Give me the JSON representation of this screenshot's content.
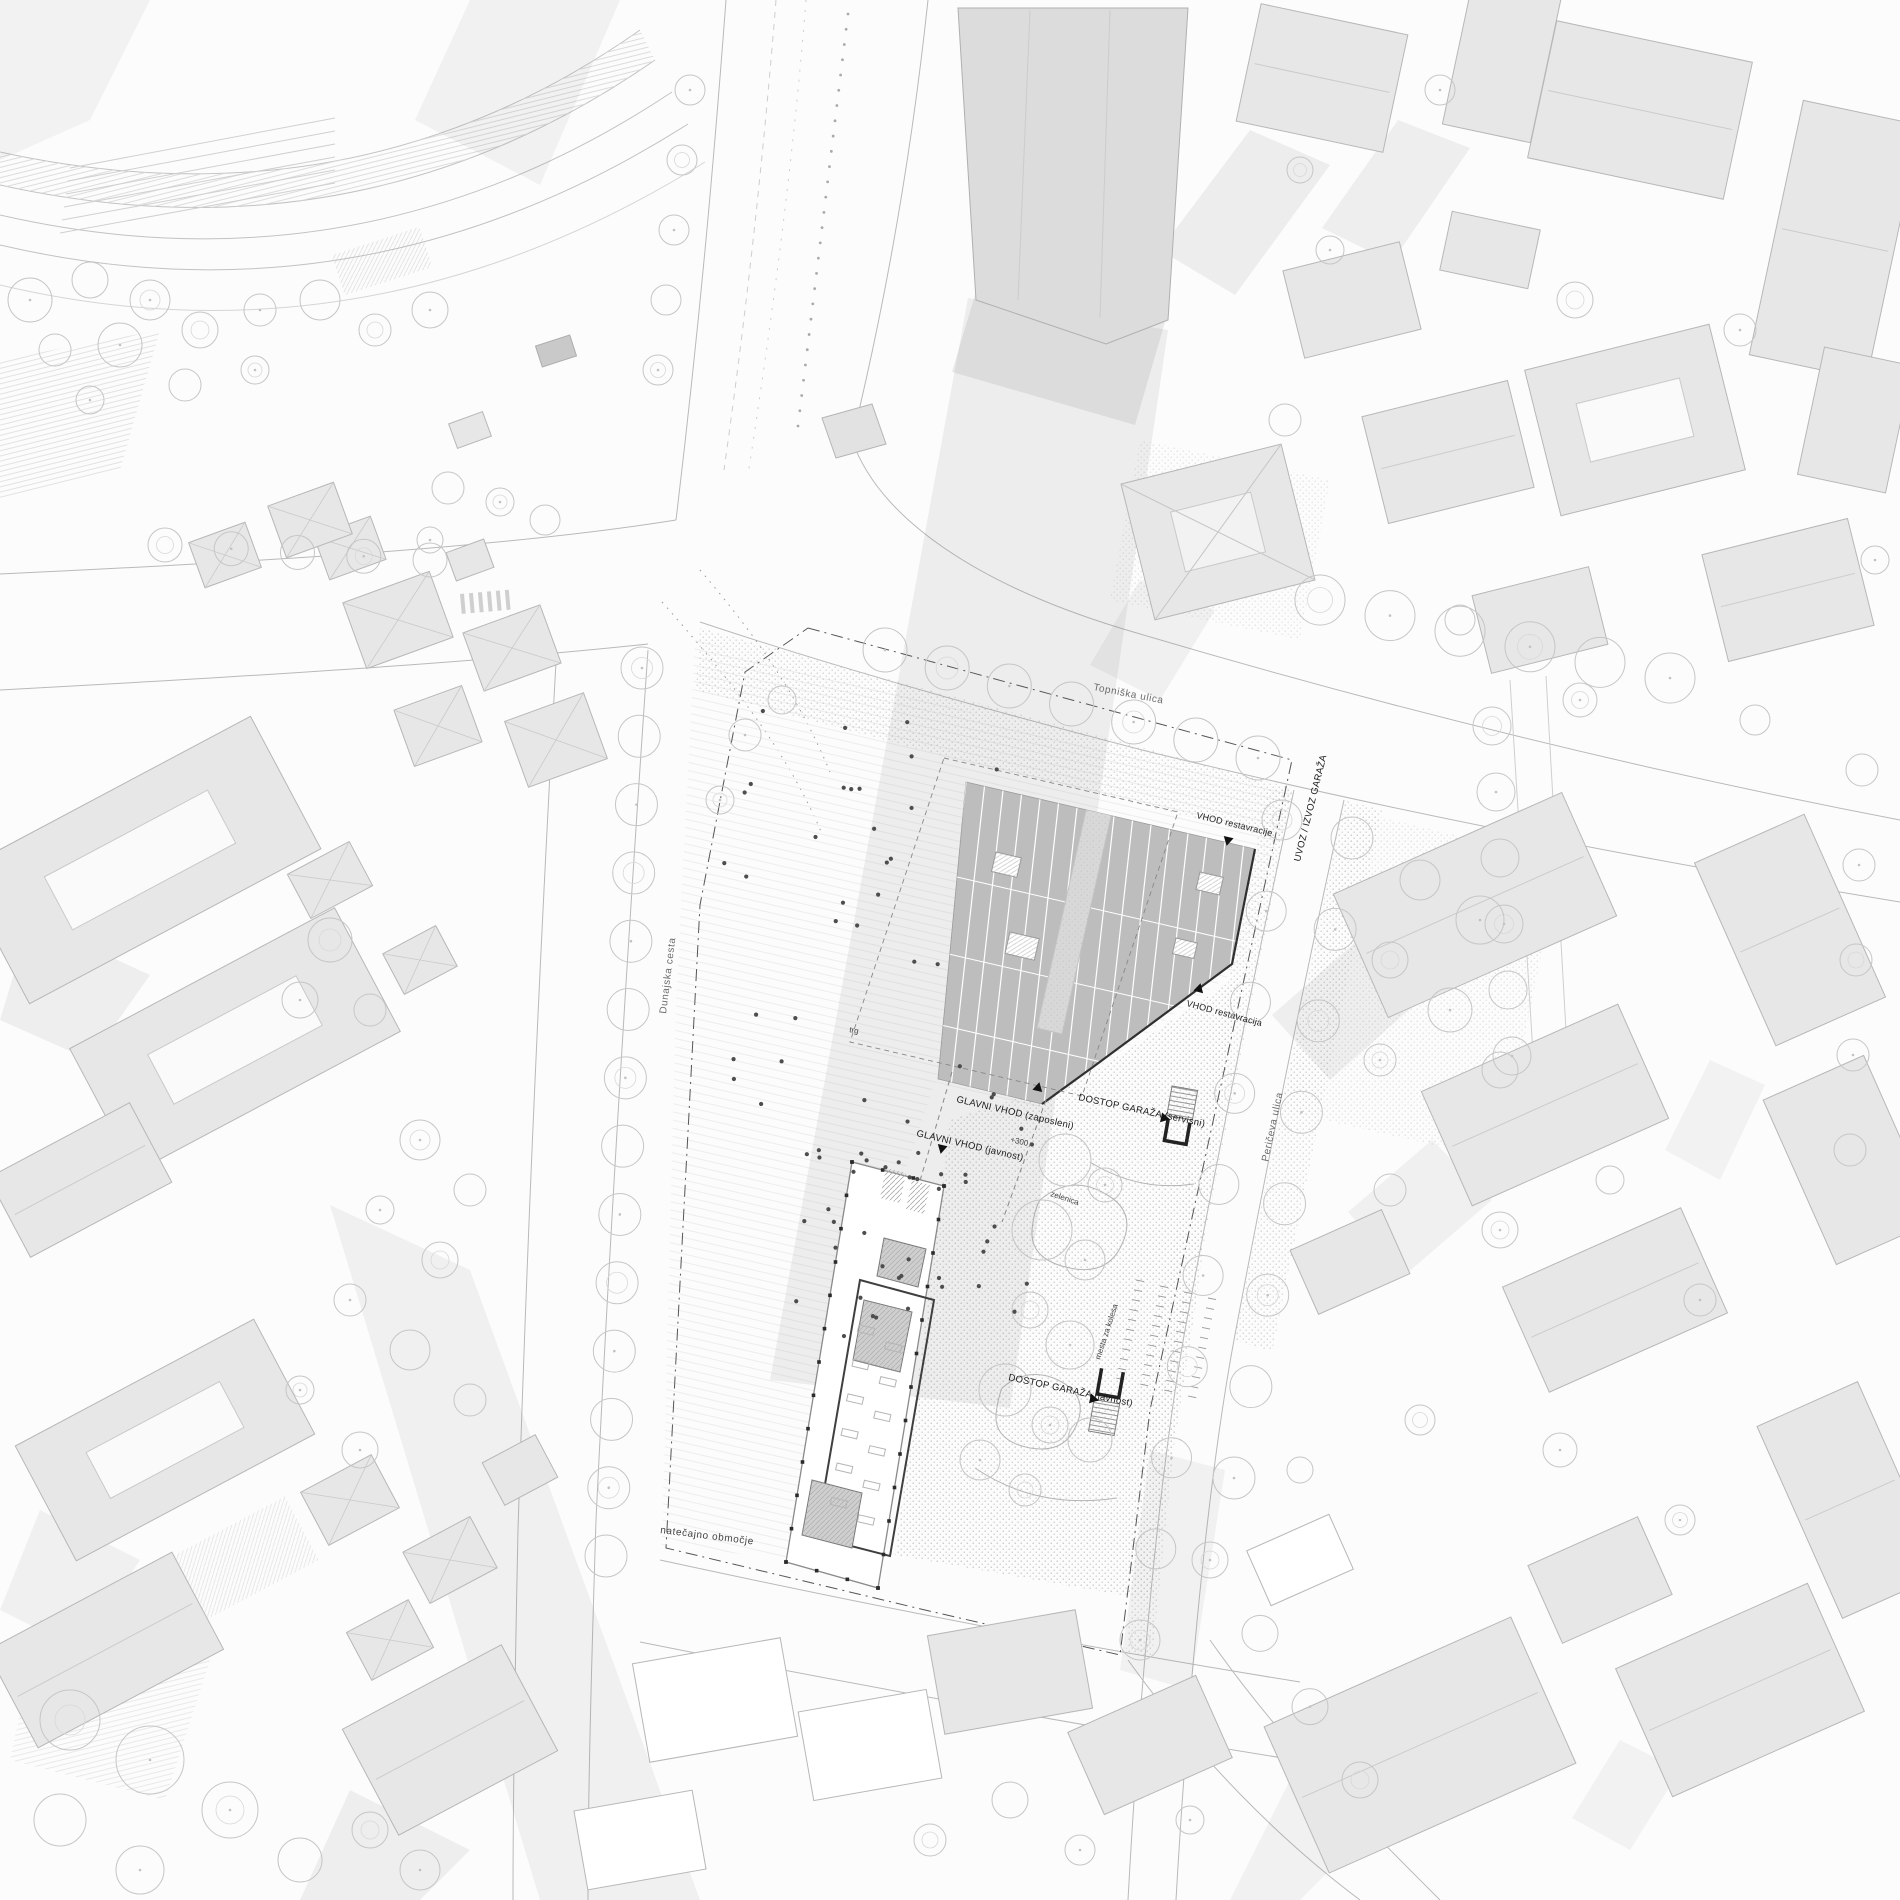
{
  "drawing": {
    "type": "architectural competition site plan (roof / ground floor plan)",
    "streets": {
      "topniska": "Topniška ulica",
      "dunajska": "Dunajska cesta",
      "periceva": "Peričeva ulica"
    },
    "annotations": {
      "uvoz_izvoz_garaza": "UVOZ / IZVOZ GARAŽA",
      "vhod_restavracije": "VHOD restavracije",
      "vhod_restavracija": "VHOD restavracija",
      "glavni_vhod_zaposleni": "GLAVNI VHOD (zaposleni)",
      "glavni_vhod_javnost": "GLAVNI VHOD (javnost)",
      "dostop_garaza_servisni": "DOSTOP GARAŽA (servisni)",
      "dostop_garaza_javnost": "DOSTOP GARAŽA (javnost)",
      "zelenica": "zelenica",
      "mesta_za_kolesa": "mesta za kolesa",
      "trg": "trg",
      "natecajno_obmocje": "natečajno območje",
      "elevation": "+300"
    },
    "colors": {
      "background": "#fcfcfc",
      "building_fill": "#e7e7e7",
      "building_stroke": "#b7b7b7",
      "proposed_building_fill": "#bdbdbd",
      "proposed_building_edge": "#2f2f2f",
      "shadow": "#8e8e8e",
      "tree_stroke": "#c6c6c6",
      "boundary_line": "#555555",
      "label_text": "#222222"
    }
  }
}
